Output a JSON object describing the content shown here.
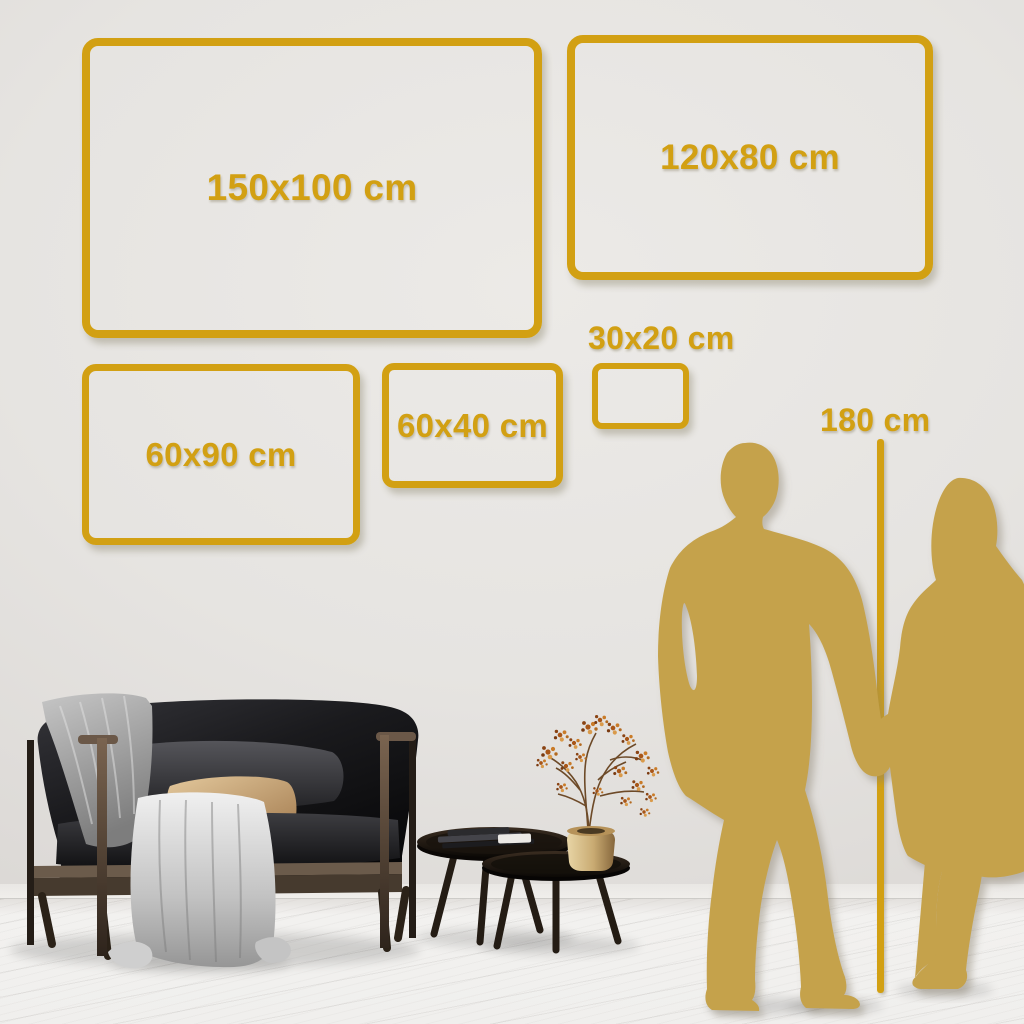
{
  "frames": [
    {
      "label": "150x100 cm"
    },
    {
      "label": "120x80 cm"
    },
    {
      "label": "60x90 cm"
    },
    {
      "label": "60x40 cm"
    },
    {
      "label": "30x20 cm"
    }
  ],
  "height_marker": {
    "label": "180 cm"
  },
  "colors": {
    "frame_gold": "#D2A013",
    "silhouette_gold": "#C5A24C",
    "wall_light": "#EBE9E6",
    "wall_dark": "#D2CFCC",
    "floor": "#F1F0EE",
    "pillow_beige": "#D2B080",
    "blanket_gray": "#ADADAD"
  },
  "decor": {
    "sofa": "black-velvet-loveseat-with-wood-frame",
    "blanket": "gray-throw-blanket",
    "pillows": [
      "dark-gray-pillow",
      "beige-pillow"
    ],
    "tables": "two-round-nesting-coffee-tables",
    "books": "stacked-books",
    "vase": "brass-vase",
    "plant": "dried-branch-with-rust-berries",
    "people": [
      "man-silhouette",
      "woman-silhouette"
    ]
  }
}
